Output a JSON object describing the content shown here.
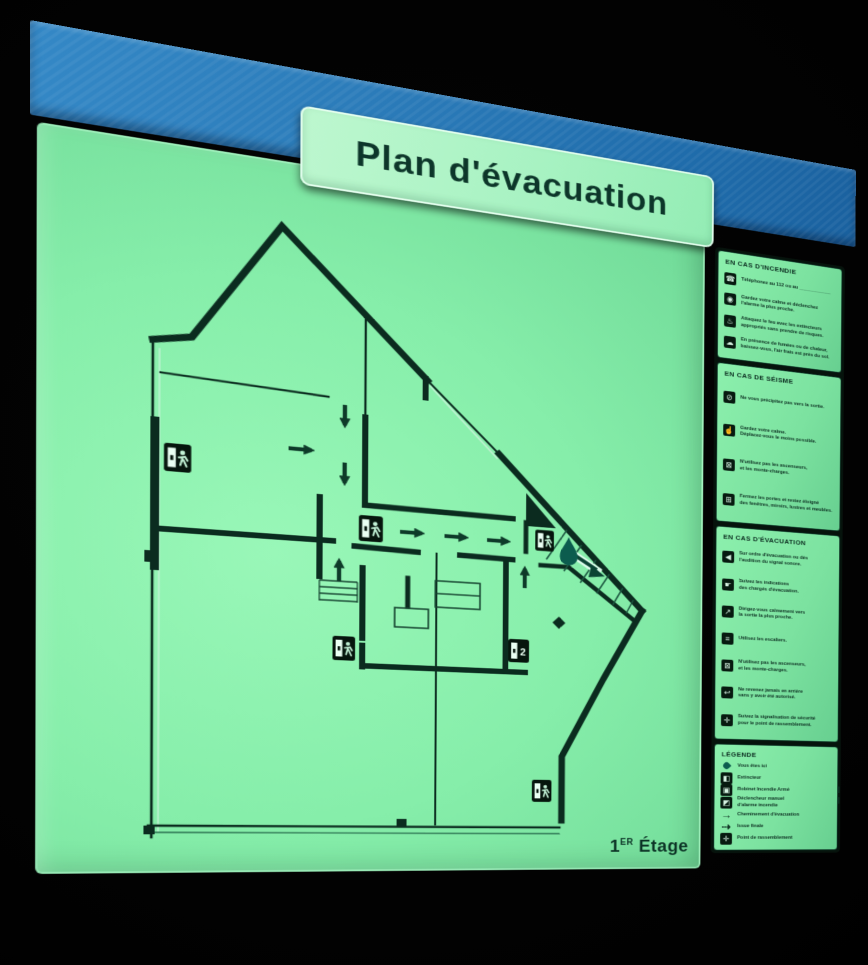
{
  "title": "Plan d'évacuation",
  "floor": {
    "number": "1",
    "sup": "ER",
    "word": "Étage"
  },
  "colors": {
    "band_blue": "#2a7ab8",
    "panel_green": "#86eeaa",
    "plate_green": "#a7f2c2",
    "ink": "#0b2d20",
    "teal_marker": "#0c5c4e"
  },
  "map": {
    "floor_label": "1ER Étage",
    "you_are_here_marker": "Vous êtes ici",
    "exit_sign_count": 6
  },
  "sidebar": {
    "sections": [
      {
        "id": "incendie",
        "title": "EN CAS D'INCENDIE",
        "items": [
          {
            "icon": "phone-icon",
            "glyph": "☎",
            "lines": [
              "Téléphonez au 112 ou au ____________"
            ]
          },
          {
            "icon": "alarm-icon",
            "glyph": "◉",
            "lines": [
              "Gardez votre calme et déclenchez",
              "l'alarme la plus proche."
            ]
          },
          {
            "icon": "extinguisher-icon",
            "glyph": "♨",
            "lines": [
              "Attaquez le feu avec les extincteurs",
              "appropriés sans prendre de risques."
            ]
          },
          {
            "icon": "smoke-icon",
            "glyph": "☁",
            "lines": [
              "En présence de fumées ou de chaleur,",
              "baissez-vous, l'air frais est près du sol."
            ]
          }
        ]
      },
      {
        "id": "seisme",
        "title": "EN CAS DE SÉISME",
        "items": [
          {
            "icon": "no-run-icon",
            "glyph": "⊘",
            "lines": [
              "Ne vous précipitez pas vers la sortie."
            ]
          },
          {
            "icon": "calm-icon",
            "glyph": "☝",
            "lines": [
              "Gardez votre calme.",
              "Déplacez-vous le moins possible."
            ]
          },
          {
            "icon": "no-elevator-icon",
            "glyph": "⊠",
            "lines": [
              "N'utilisez pas les ascenseurs,",
              "et les monte-charges."
            ]
          },
          {
            "icon": "windows-icon",
            "glyph": "⊞",
            "lines": [
              "Fermez les portes et restez éloigné",
              "des fenêtres, miroirs, lustres et meubles."
            ]
          }
        ]
      },
      {
        "id": "evacuation",
        "title": "EN CAS D'ÉVACUATION",
        "items": [
          {
            "icon": "signal-icon",
            "glyph": "◀",
            "lines": [
              "Sur ordre d'évacuation ou dès",
              "l'audition du signal sonore."
            ]
          },
          {
            "icon": "guide-icon",
            "glyph": "☛",
            "lines": [
              "Suivez les indications",
              "des chargés d'évacuation."
            ]
          },
          {
            "icon": "direction-icon",
            "glyph": "↗",
            "lines": [
              "Dirigez-vous calmement vers",
              "la sortie la plus proche."
            ]
          },
          {
            "icon": "stairs-icon",
            "glyph": "≡",
            "lines": [
              "Utilisez les escaliers."
            ]
          },
          {
            "icon": "no-elevator-icon",
            "glyph": "⊠",
            "lines": [
              "N'utilisez pas les ascenseurs,",
              "et les monte-charges."
            ]
          },
          {
            "icon": "no-return-icon",
            "glyph": "↩",
            "lines": [
              "Ne revenez jamais en arrière",
              "sans y avoir été autorisé."
            ]
          },
          {
            "icon": "assembly-icon",
            "glyph": "✛",
            "lines": [
              "Suivez la signalisation de sécurité",
              "pour le point de rassemblement."
            ]
          }
        ]
      },
      {
        "id": "legende",
        "title": "LÉGENDE",
        "items": [
          {
            "icon": "you-are-here-icon",
            "style": "drop",
            "glyph": "",
            "lines": [
              "Vous êtes ici"
            ]
          },
          {
            "icon": "extinguisher-legend-icon",
            "glyph": "◧",
            "lines": [
              "Extincteur"
            ]
          },
          {
            "icon": "ria-icon",
            "glyph": "▣",
            "lines": [
              "Robinet Incendie Armé"
            ]
          },
          {
            "icon": "alarm-trigger-icon",
            "glyph": "◩",
            "lines": [
              "Déclencheur manuel",
              "d'alarme incendie"
            ]
          },
          {
            "icon": "route-arrow-icon",
            "style": "arrow",
            "glyph": "→",
            "lines": [
              "Cheminement d'évacuation"
            ]
          },
          {
            "icon": "final-exit-icon",
            "style": "arrow",
            "glyph": "⇢",
            "lines": [
              "Issue finale"
            ]
          },
          {
            "icon": "assembly-point-icon",
            "glyph": "✛",
            "lines": [
              "Point de rassemblement"
            ]
          }
        ]
      }
    ]
  }
}
